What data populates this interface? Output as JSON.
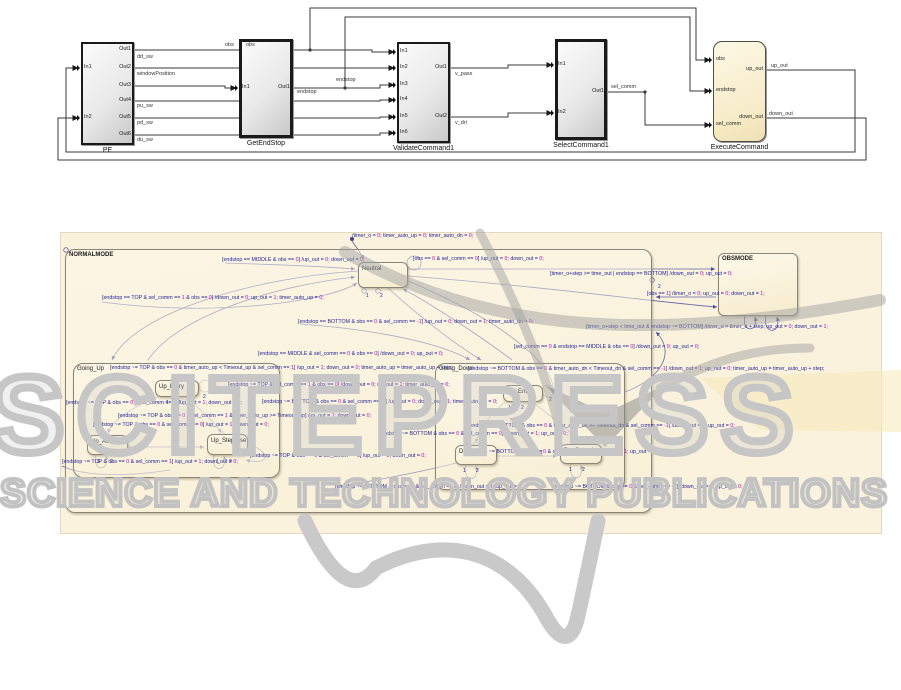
{
  "colors": {
    "wire": "#3a3a3a",
    "transition": "#6565ab",
    "chart_bg": "#faf2dd",
    "label_text": "#23239b",
    "label_num": "#c000c0",
    "watermark_gray": "#c6c6c6",
    "watermark_yellow": "#f7e9b8"
  },
  "block_diagram": {
    "blocks": [
      {
        "id": "pe",
        "label": "PE",
        "x": 81,
        "y": 42,
        "w": 53,
        "h": 103,
        "kind": "subsystem",
        "in": [
          {
            "label": "In1",
            "y": 26
          },
          {
            "label": "In2",
            "y": 76
          }
        ],
        "out": [
          {
            "label": "Out1",
            "y": 8
          },
          {
            "label": "Out2",
            "y": 26
          },
          {
            "label": "Out3",
            "y": 44
          },
          {
            "label": "Out4",
            "y": 59
          },
          {
            "label": "Out5",
            "y": 76
          },
          {
            "label": "Out6",
            "y": 93
          }
        ]
      },
      {
        "id": "getendstop",
        "label": "GetEndStop",
        "x": 239,
        "y": 39,
        "w": 54,
        "h": 99,
        "kind": "subsystem-bold",
        "in": [
          {
            "label": "In1",
            "y": 49
          }
        ],
        "out": [
          {
            "label": "Out1",
            "y": 49
          }
        ]
      },
      {
        "id": "validatecommand1",
        "label": "ValidateCommand1",
        "x": 397,
        "y": 42,
        "w": 53,
        "h": 101,
        "kind": "subsystem",
        "in": [
          {
            "label": "In1",
            "y": 10
          },
          {
            "label": "In2",
            "y": 26
          },
          {
            "label": "In3",
            "y": 43
          },
          {
            "label": "In4",
            "y": 58
          },
          {
            "label": "In5",
            "y": 75
          },
          {
            "label": "In6",
            "y": 91
          }
        ],
        "out": [
          {
            "label": "Out1",
            "y": 26
          },
          {
            "label": "Out2",
            "y": 75
          }
        ]
      },
      {
        "id": "selectcommand1",
        "label": "SelectCommand1",
        "x": 555,
        "y": 39,
        "w": 52,
        "h": 101,
        "kind": "subsystem-bold",
        "in": [
          {
            "label": "In1",
            "y": 26
          },
          {
            "label": "In2",
            "y": 74
          }
        ],
        "out": [
          {
            "label": "Out1",
            "y": 53
          }
        ]
      },
      {
        "id": "executecommand",
        "label": "ExecuteCommand",
        "x": 713,
        "y": 41,
        "w": 53,
        "h": 101,
        "kind": "chart",
        "in": [
          {
            "label": "obs",
            "y": 19
          },
          {
            "label": "endstop",
            "y": 50
          },
          {
            "label": "sel_comm",
            "y": 84
          }
        ],
        "out": [
          {
            "label": "up_out",
            "y": 29
          },
          {
            "label": "down_out",
            "y": 77
          }
        ]
      }
    ],
    "wire_labels": [
      {
        "text": "obs",
        "x": 225,
        "y": 43
      },
      {
        "text": "obs",
        "x": 246,
        "y": 43
      },
      {
        "text": "dd_sw",
        "x": 137,
        "y": 55
      },
      {
        "text": "windowPosition",
        "x": 137,
        "y": 72
      },
      {
        "text": "pu_sw",
        "x": 137,
        "y": 104
      },
      {
        "text": "pd_sw",
        "x": 137,
        "y": 121
      },
      {
        "text": "du_sw",
        "x": 137,
        "y": 138
      },
      {
        "text": "endstop",
        "x": 297,
        "y": 90
      },
      {
        "text": "endstop",
        "x": 336,
        "y": 78
      },
      {
        "text": "v_pass",
        "x": 455,
        "y": 72
      },
      {
        "text": "v_dri",
        "x": 455,
        "y": 121
      },
      {
        "text": "sel_comm",
        "x": 611,
        "y": 85
      },
      {
        "text": "up_out",
        "x": 771,
        "y": 64
      },
      {
        "text": "down_out",
        "x": 769,
        "y": 112
      }
    ],
    "wires": [
      "M134,50 H372 V52 H394",
      "M310,50 V8 H696 V60 H710",
      "M134,68 H394",
      "M134,86 H225 V88 H236",
      "M293,88 H345 V17 H690 V91 H710",
      "M345,88 H380 V85 H394",
      "M134,101 H380 V100 H394",
      "M134,118 H380 V117 H394",
      "M134,135 H380 V133 H394",
      "M450,68 H508 V65 H552",
      "M450,117 H508 V113 H552",
      "M607,92 H645 V125 H710",
      "M766,70 H855 V152 H66 V68 H78",
      "M766,118 H866 V160 H58 V118 H78"
    ],
    "wire_dots": [
      [
        310,
        50
      ],
      [
        345,
        88
      ],
      [
        645,
        92
      ]
    ],
    "chart_icon_paths": [
      "M722,83 a3,3 0 0 1 3,-3 h12 a3,3 0 0 1 3,3 v7 a3,3 0 0 1 -3,3 h-12 a3,3 0 0 1 -3,-3 z",
      "M736,99 a3,3 0 0 1 3,-3 h12 a3,3 0 0 1 3,3 v7 a3,3 0 0 1 -3,3 h-12 a3,3 0 0 1 -3,-3 z",
      "M742,77 C748,74 751,79 749,84",
      "M733,98 C727,101 724,96 726,90"
    ]
  },
  "statechart": {
    "canvas": {
      "x": 60,
      "y": 232,
      "w": 820,
      "h": 300
    },
    "states": [
      {
        "name": "NORMALMODE",
        "x": 65,
        "y": 249,
        "w": 587,
        "h": 264,
        "type": "container"
      },
      {
        "name": "OBSMODE",
        "x": 718,
        "y": 253,
        "w": 80,
        "h": 63,
        "type": "state"
      },
      {
        "name": "Neutral",
        "x": 358,
        "y": 262,
        "w": 50,
        "h": 26,
        "type": "state"
      },
      {
        "name": "Going_Up",
        "x": 73,
        "y": 363,
        "w": 207,
        "h": 115,
        "type": "container"
      },
      {
        "name": "Up_Entry",
        "x": 155,
        "y": 380,
        "w": 44,
        "h": 17,
        "type": "state"
      },
      {
        "name": "Up_Auto",
        "x": 87,
        "y": 435,
        "w": 41,
        "h": 20,
        "type": "state"
      },
      {
        "name": "Up_Stepwise",
        "x": 207,
        "y": 434,
        "w": 41,
        "h": 21,
        "type": "state"
      },
      {
        "name": "Going_Down",
        "x": 435,
        "y": 363,
        "w": 190,
        "h": 127,
        "type": "container"
      },
      {
        "name": "Dn_Entry",
        "x": 503,
        "y": 385,
        "w": 40,
        "h": 17,
        "type": "state"
      },
      {
        "name": "Dn_Auto",
        "x": 455,
        "y": 445,
        "w": 42,
        "h": 20,
        "type": "state"
      },
      {
        "name": "Dn_Stepwise",
        "x": 560,
        "y": 444,
        "w": 42,
        "h": 20,
        "type": "state"
      }
    ],
    "transition_labels": [
      {
        "x": 352,
        "y": 234,
        "text": "/timer_o = 0; timer_auto_up = 0; timer_auto_dn = 0;"
      },
      {
        "x": 222,
        "y": 258,
        "text": "[endstop == MIDDLE & obs == 0] /up_out = 0; down_out = 0;"
      },
      {
        "x": 413,
        "y": 257,
        "text": "[obs == 0 & sel_comm == 0] /up_out = 0; down_out = 0;"
      },
      {
        "x": 550,
        "y": 272,
        "text": "[timer_o+step >= time_out | endstop == BOTTOM] /down_out = 0; up_out = 0;"
      },
      {
        "x": 647,
        "y": 292,
        "text": "[obs == 1] /timer_o = 0; up_out = 0; down_out = 1;"
      },
      {
        "x": 102,
        "y": 296,
        "text": "[endstop == TOP & sel_comm == 1 & obs == 0] /down_out = 0; up_out = 1; timer_auto_up = 0;"
      },
      {
        "x": 298,
        "y": 320,
        "text": "[endstop == BOTTOM & obs == 0 & sel_comm == -1] /up_out = 0; down_out = 1; timer_auto_dn = 0;"
      },
      {
        "x": 586,
        "y": 325,
        "text": "[timer_o+step < time_out & endstop ~= BOTTOM] /timer_o = timer_o + step; up_out = 0; down_out = 1;"
      },
      {
        "x": 258,
        "y": 352,
        "text": "[endstop == MIDDLE & sel_comm == 0 & obs == 0] /down_out = 0; up_out = 0;"
      },
      {
        "x": 514,
        "y": 345,
        "text": "[sel_comm == 0 & endstop == MIDDLE & obs == 0] /down_out = 0; up_out = 0;"
      },
      {
        "x": 110,
        "y": 366,
        "text": "[endstop ~= TOP & obs == 0 & timer_auto_up < Timeout_up & sel_comm == 1] /up_out = 1; down_out = 0; timer_auto_up = timer_auto_up + step;"
      },
      {
        "x": 468,
        "y": 367,
        "text": "[endstop ~= BOTTOM & obs == 0 & timer_auto_dn < Timeout_dn & sel_comm == -1] /down_out = 1; up_out = 0; timer_auto_up = timer_auto_up + step;"
      },
      {
        "x": 228,
        "y": 383,
        "text": "[endstop ~= TOP & sel_comm == 1 & obs == 0] /down_out = 0; up_out = 1; timer_auto_up = 0;"
      },
      {
        "x": 262,
        "y": 400,
        "text": "[endstop ~= BOTTOM & obs == 0 & sel_comm == -1] /up_out = 0; down_out = 1; timer_auto_dn = 0;"
      },
      {
        "x": 66,
        "y": 401,
        "text": "[endstop ~= TOP & obs == 0 & sel_comm == 0] /up_out = 1; down_out = 0;"
      },
      {
        "x": 118,
        "y": 414,
        "text": "[endstop ~= TOP & obs == 0 & sel_comm == 1 & timer_auto_up >= Timeout_up] /up_out = 1; down_out = 0;"
      },
      {
        "x": 93,
        "y": 423,
        "text": "[endstop ~= TOP & obs == 0 & sel_comm == 0] /up_out = 1; down_out = 0;"
      },
      {
        "x": 468,
        "y": 424,
        "text": "[endstop ~= BOTTOM & obs == 0 & timer_auto_dn >= Timeout_dn & sel_comm == -1] /down_out = 1; up_out = 0;"
      },
      {
        "x": 380,
        "y": 432,
        "text": "[endstop ~= BOTTOM & obs == 0 & sel_comm == 0] /down_out = 1; up_out = 0;"
      },
      {
        "x": 250,
        "y": 454,
        "text": "[endstop ~= TOP & obs == 0 & sel_comm == 1] /up_out = 1; down_out = 0;"
      },
      {
        "x": 62,
        "y": 460,
        "text": "[endstop ~= TOP & obs == 0 & sel_comm == 1] /up_out = 1; down_out = 0;"
      },
      {
        "x": 467,
        "y": 450,
        "text": "[endstop ~= BOTTOM & obs == 0 & sel_comm == -1] /down_out = 1; up_out = 0;"
      },
      {
        "x": 335,
        "y": 485,
        "text": "[endstop ~= BOTTOM & obs == 0 & sel_comm == 0] /down_out = 1; up_out = 0;"
      },
      {
        "x": 553,
        "y": 485,
        "text": "[endstop ~= BOTTOM & obs == 0 & sel_comm == -1] /down_out = 1; up_out = 0;"
      }
    ],
    "junction_numbers": [
      {
        "t": "1",
        "x": 366,
        "y": 294
      },
      {
        "t": "2",
        "x": 380,
        "y": 294
      },
      {
        "t": "2",
        "x": 203,
        "y": 395
      },
      {
        "t": "1",
        "x": 166,
        "y": 401
      },
      {
        "t": "2",
        "x": 178,
        "y": 401
      },
      {
        "t": "1",
        "x": 97,
        "y": 460
      },
      {
        "t": "2",
        "x": 110,
        "y": 460
      },
      {
        "t": "1",
        "x": 216,
        "y": 460
      },
      {
        "t": "2",
        "x": 229,
        "y": 460
      },
      {
        "t": "2",
        "x": 549,
        "y": 398
      },
      {
        "t": "1",
        "x": 508,
        "y": 406
      },
      {
        "t": "2",
        "x": 521,
        "y": 406
      },
      {
        "t": "1",
        "x": 463,
        "y": 469
      },
      {
        "t": "2",
        "x": 476,
        "y": 469
      },
      {
        "t": "1",
        "x": 569,
        "y": 468
      },
      {
        "t": "2",
        "x": 582,
        "y": 468
      },
      {
        "t": "1",
        "x": 540,
        "y": 451
      },
      {
        "t": "2",
        "x": 658,
        "y": 285
      }
    ],
    "curves": [
      {
        "d": "M352,241 C357,248 361,254 364,259",
        "arrow": true
      },
      {
        "d": "M358,271 C250,278 133,314 112,360",
        "arrow": true
      },
      {
        "d": "M148,360 C174,320 264,287 355,277",
        "arrow": true
      },
      {
        "d": "M388,288 C420,317 452,342 481,360",
        "arrow": true
      },
      {
        "d": "M512,360 C472,330 424,300 403,289",
        "arrow": true
      },
      {
        "d": "M225,263 C292,265 330,267 355,269",
        "arrow": true
      },
      {
        "d": "M102,302 C220,318 332,300 357,283",
        "arrow": true
      },
      {
        "d": "M408,269 H715",
        "arrow": true
      },
      {
        "d": "M716,297 H656",
        "arrow": true
      },
      {
        "d": "M408,276 C560,288 662,303 717,307",
        "arrow": true
      },
      {
        "d": "M300,324 C382,330 442,344 470,360",
        "arrow": true
      },
      {
        "d": "M408,281 C520,328 560,375 552,393",
        "arrow": true
      },
      {
        "d": "M625,392 C662,378 676,352 656,332",
        "arrow": true
      },
      {
        "d": "M158,397 C130,408 112,421 108,433",
        "arrow": true
      },
      {
        "d": "M186,397 C202,412 216,422 221,433",
        "arrow": true
      },
      {
        "d": "M128,447 H204",
        "arrow": true
      },
      {
        "d": "M505,402 C488,417 478,430 476,443",
        "arrow": true
      },
      {
        "d": "M532,402 C552,418 570,428 577,442",
        "arrow": true
      },
      {
        "d": "M497,456 H557",
        "arrow": true
      },
      {
        "d": "M96,455 C92,472 110,472 106,456",
        "arrow": true
      },
      {
        "d": "M214,455 C210,473 228,473 224,456",
        "arrow": true
      },
      {
        "d": "M466,465 C462,483 480,483 476,466",
        "arrow": true
      },
      {
        "d": "M571,464 C567,482 585,482 581,465",
        "arrow": true
      },
      {
        "d": "M745,316 C741,333 759,333 755,317",
        "arrow": true
      },
      {
        "d": "M766,316 C762,335 782,335 777,317",
        "arrow": true
      },
      {
        "d": "M62,466 C80,475 120,478 170,470",
        "arrow": false
      },
      {
        "d": "M340,486 C380,480 430,470 460,462",
        "arrow": false
      },
      {
        "d": "M248,444 C272,452 270,466 246,460",
        "arrow": true
      }
    ],
    "loop_circles": [
      {
        "cx": 414,
        "cy": 263,
        "r": 7
      },
      {
        "cx": 205,
        "cy": 386,
        "r": 6
      },
      {
        "cx": 548,
        "cy": 391,
        "r": 6
      }
    ],
    "junction_circles": [
      [
        364,
        291
      ],
      [
        378,
        291
      ],
      [
        107,
        434
      ],
      [
        222,
        434
      ],
      [
        476,
        444
      ],
      [
        578,
        443
      ],
      [
        66,
        250
      ],
      [
        652,
        280
      ]
    ],
    "default_dots": [
      [
        352,
        239
      ]
    ]
  },
  "watermark": {
    "row1": "SCITEPRESS",
    "row2": "SCIENCE AND TECHNOLOGY PUBLICATIONS",
    "ribbons": [
      {
        "d": "M345,252 C480,330 640,345 880,300",
        "w": 12
      },
      {
        "d": "M480,233 C515,300 545,370 560,430",
        "w": 9
      },
      {
        "d": "M660,388 C710,362 750,348 810,348",
        "w": 9
      }
    ],
    "chevron": "545,385 605,447 665,385 605,413",
    "yellow_poly": "700,378 901,370 901,432 760,430",
    "swooshes": [
      {
        "d": "M305,521 C335,585 358,592 376,568",
        "w": 15
      },
      {
        "d": "M376,568 C440,535 505,545 545,615 C558,640 570,645 577,620 C585,585 593,545 598,521",
        "w": 15
      }
    ]
  }
}
